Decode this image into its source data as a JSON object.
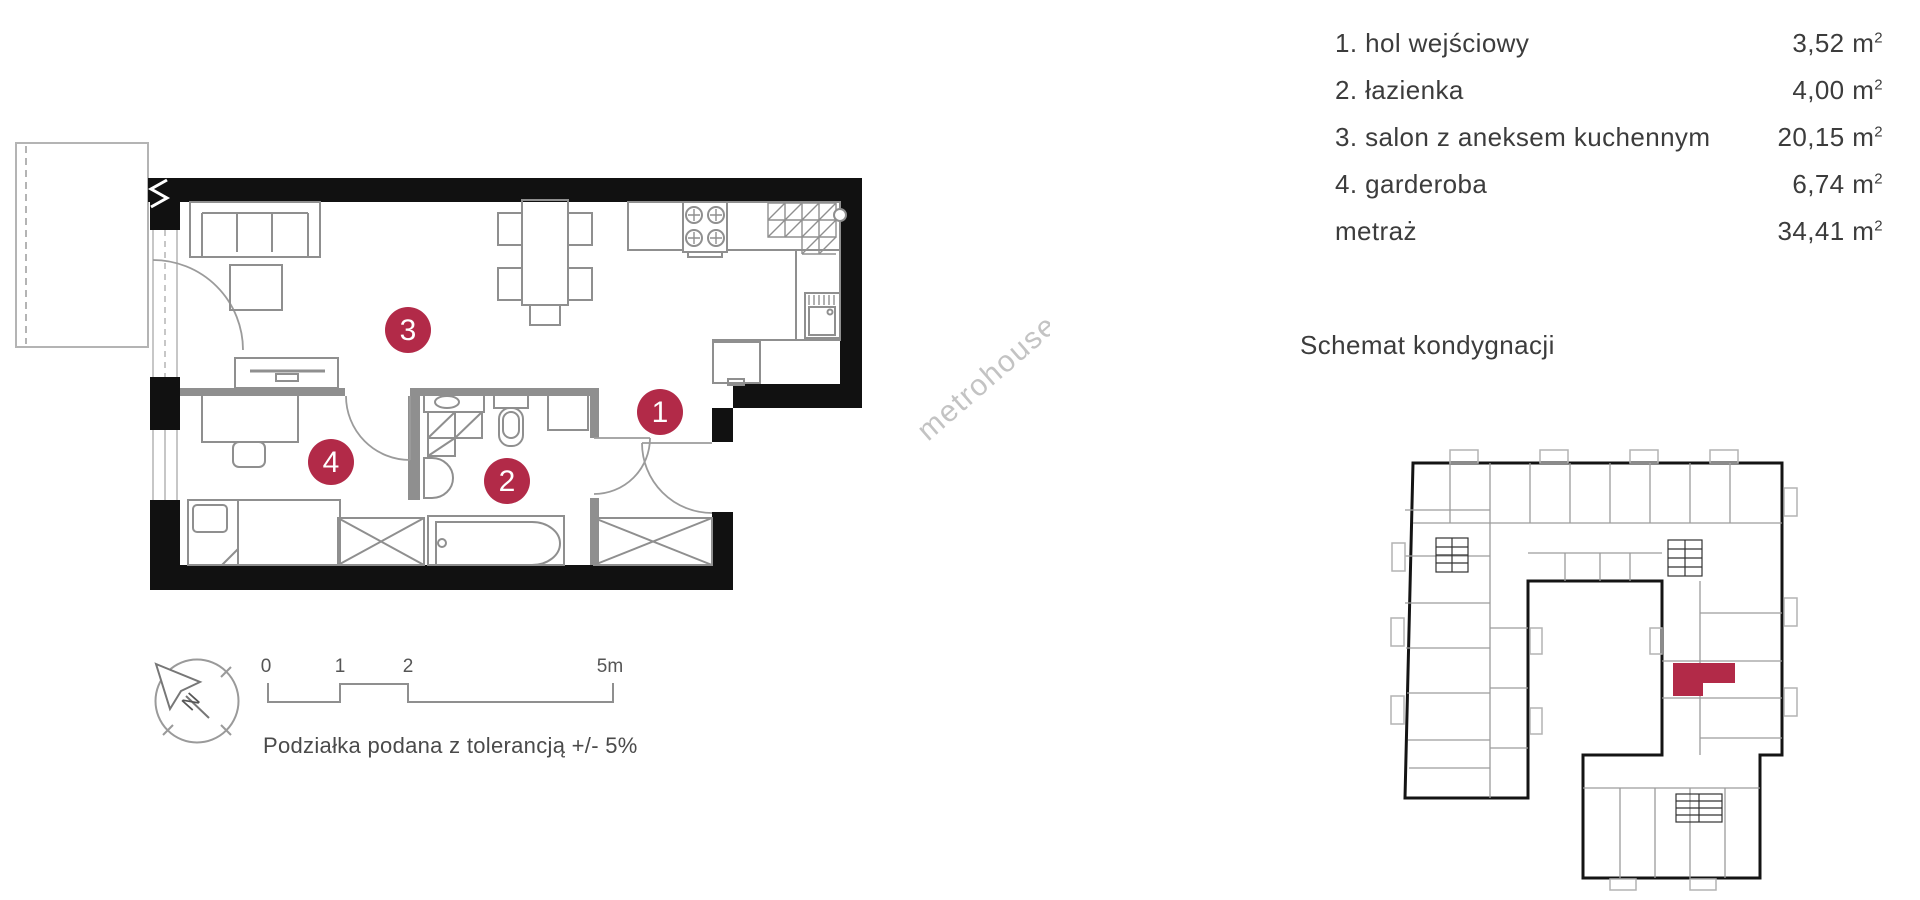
{
  "legend": {
    "items": [
      {
        "label": "1. hol wejściowy",
        "area": "3,52"
      },
      {
        "label": "2. łazienka",
        "area": "4,00"
      },
      {
        "label": "3. salon z aneksem kuchennym",
        "area": "20,15"
      },
      {
        "label": "4. garderoba",
        "area": "6,74"
      }
    ],
    "total_label": "metraż",
    "total_area": "34,41",
    "unit": "m",
    "unit_sup": "2"
  },
  "section_title": "Schemat kondygnacji",
  "plan": {
    "rooms": [
      {
        "number": "1"
      },
      {
        "number": "2"
      },
      {
        "number": "3"
      },
      {
        "number": "4"
      }
    ],
    "scale": {
      "t0": "0",
      "t1": "1",
      "t2": "2",
      "t5": "5m",
      "note": "Podziałka podana z tolerancją +/- 5%"
    },
    "compass": {
      "north": "N"
    },
    "watermark": "metrohouse"
  },
  "colors": {
    "accent": "#b22a48",
    "wall": "#111111",
    "furniture": "#8f8f8f",
    "text": "#3c3c3c"
  }
}
